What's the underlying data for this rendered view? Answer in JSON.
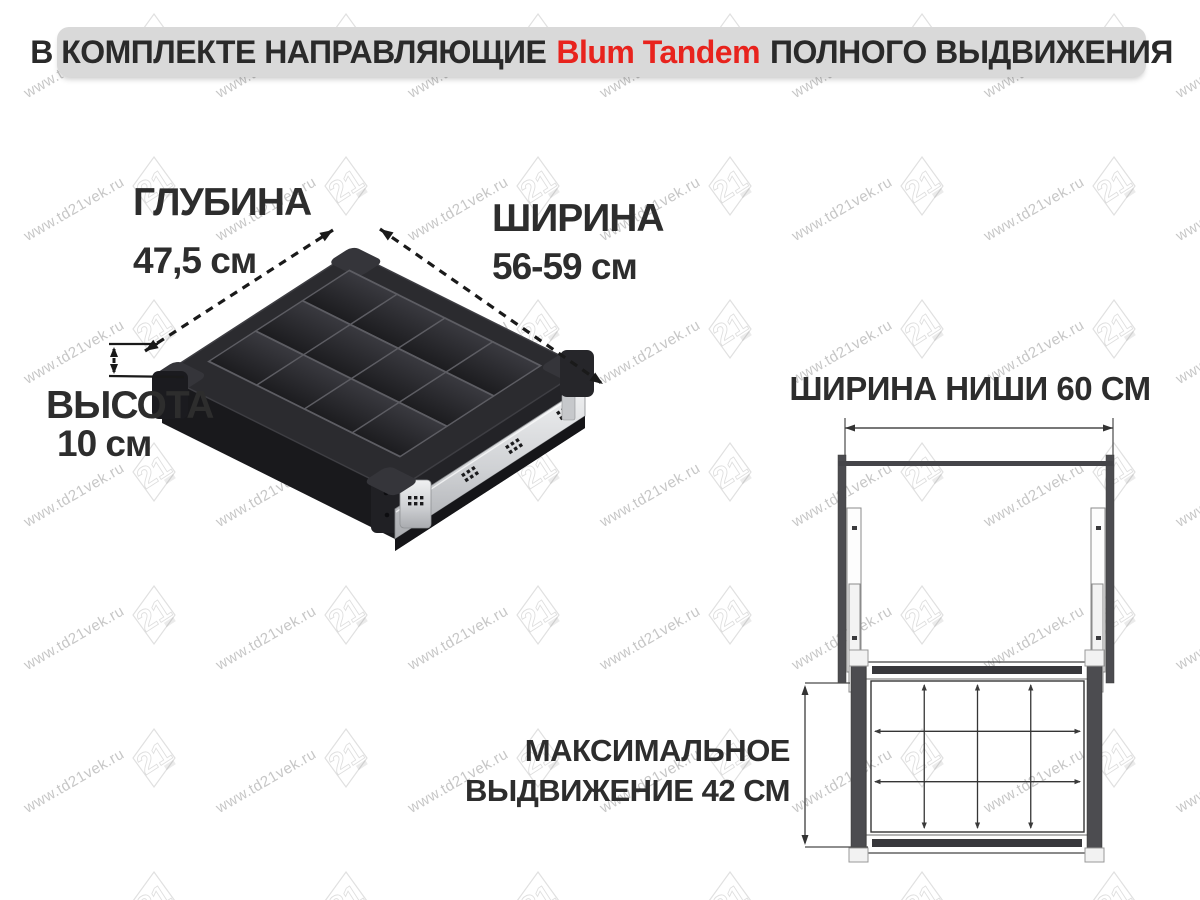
{
  "banner": {
    "text_before": "В КОМПЛЕКТЕ НАПРАВЛЯЮЩИЕ",
    "brand": "Blum Tandem",
    "text_after": "ПОЛНОГО ВЫДВИЖЕНИЯ",
    "brand_color": "#e8231d"
  },
  "product": {
    "depth_label": "ГЛУБИНА",
    "depth_value": "47,5 см",
    "width_label": "ШИРИНА",
    "width_value": "56-59 см",
    "height_label": "ВЫСОТА",
    "height_value": "10 см",
    "compartments": {
      "columns": 4,
      "rows": 3
    }
  },
  "diagram": {
    "niche_width_label": "ШИРИНА НИШИ 60 СМ",
    "max_extension_line1": "МАКСИМАЛЬНОЕ",
    "max_extension_line2": "ВЫДВИЖЕНИЕ 42 СМ",
    "grid": {
      "columns": 4,
      "rows": 3
    }
  },
  "watermark": {
    "text": "www.td21vek.ru",
    "logo": "21"
  },
  "colors": {
    "banner_bg": "#d9d9d9",
    "text": "#2d2d2d",
    "brand_red": "#e8231d",
    "drawer_black": "#2b2b2f",
    "metal": "#c9cbce",
    "diagram_line": "#3c3c3c",
    "panel_gray": "#4c4c50"
  }
}
